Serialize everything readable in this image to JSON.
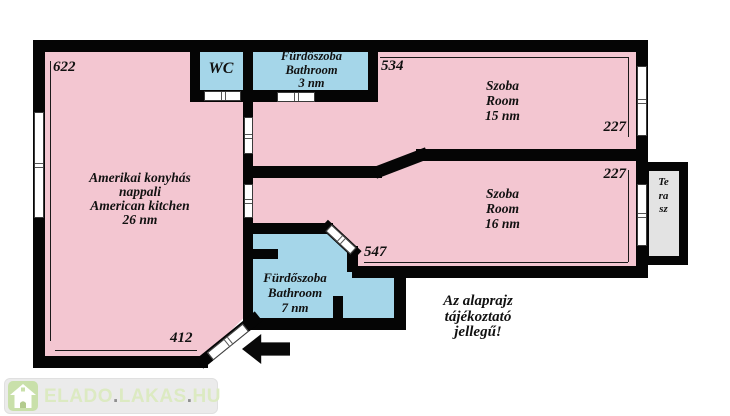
{
  "floor_plan": {
    "rooms": {
      "living": {
        "line1": "Amerikai konyhás",
        "line2": "nappali",
        "line3": "American kitchen",
        "line4": "26 nm"
      },
      "wc": {
        "label": "WC"
      },
      "bathroom_top": {
        "line1": "Fürdőszoba",
        "line2": "Bathroom",
        "line3": "3 nm"
      },
      "room_15": {
        "line1": "Szoba",
        "line2": "Room",
        "line3": "15 nm"
      },
      "room_16": {
        "line1": "Szoba",
        "line2": "Room",
        "line3": "16 nm"
      },
      "bathroom_main": {
        "line1": "Fürdőszoba",
        "line2": "Bathroom",
        "line3": "7 nm"
      },
      "terrace": {
        "label": "Terasz"
      }
    },
    "dimensions": {
      "living_left": "622",
      "room15_top": "534",
      "room15_right": "227",
      "room16_right": "227",
      "room16_bottom": "547",
      "living_bottom": "412"
    },
    "disclaimer": {
      "line1": "Az alaprajz",
      "line2": "tájékoztató",
      "line3": "jellegű!"
    },
    "colors": {
      "room_pink": "#f3c6d1",
      "wet_room_blue": "#a5d6e9",
      "terrace_gray": "#e3e3e3",
      "wall_black": "#050505"
    }
  },
  "watermark": {
    "part1": "ELADO",
    "dot1": ".",
    "part2": "LAKAS",
    "dot2": ".",
    "part3": "HU"
  }
}
